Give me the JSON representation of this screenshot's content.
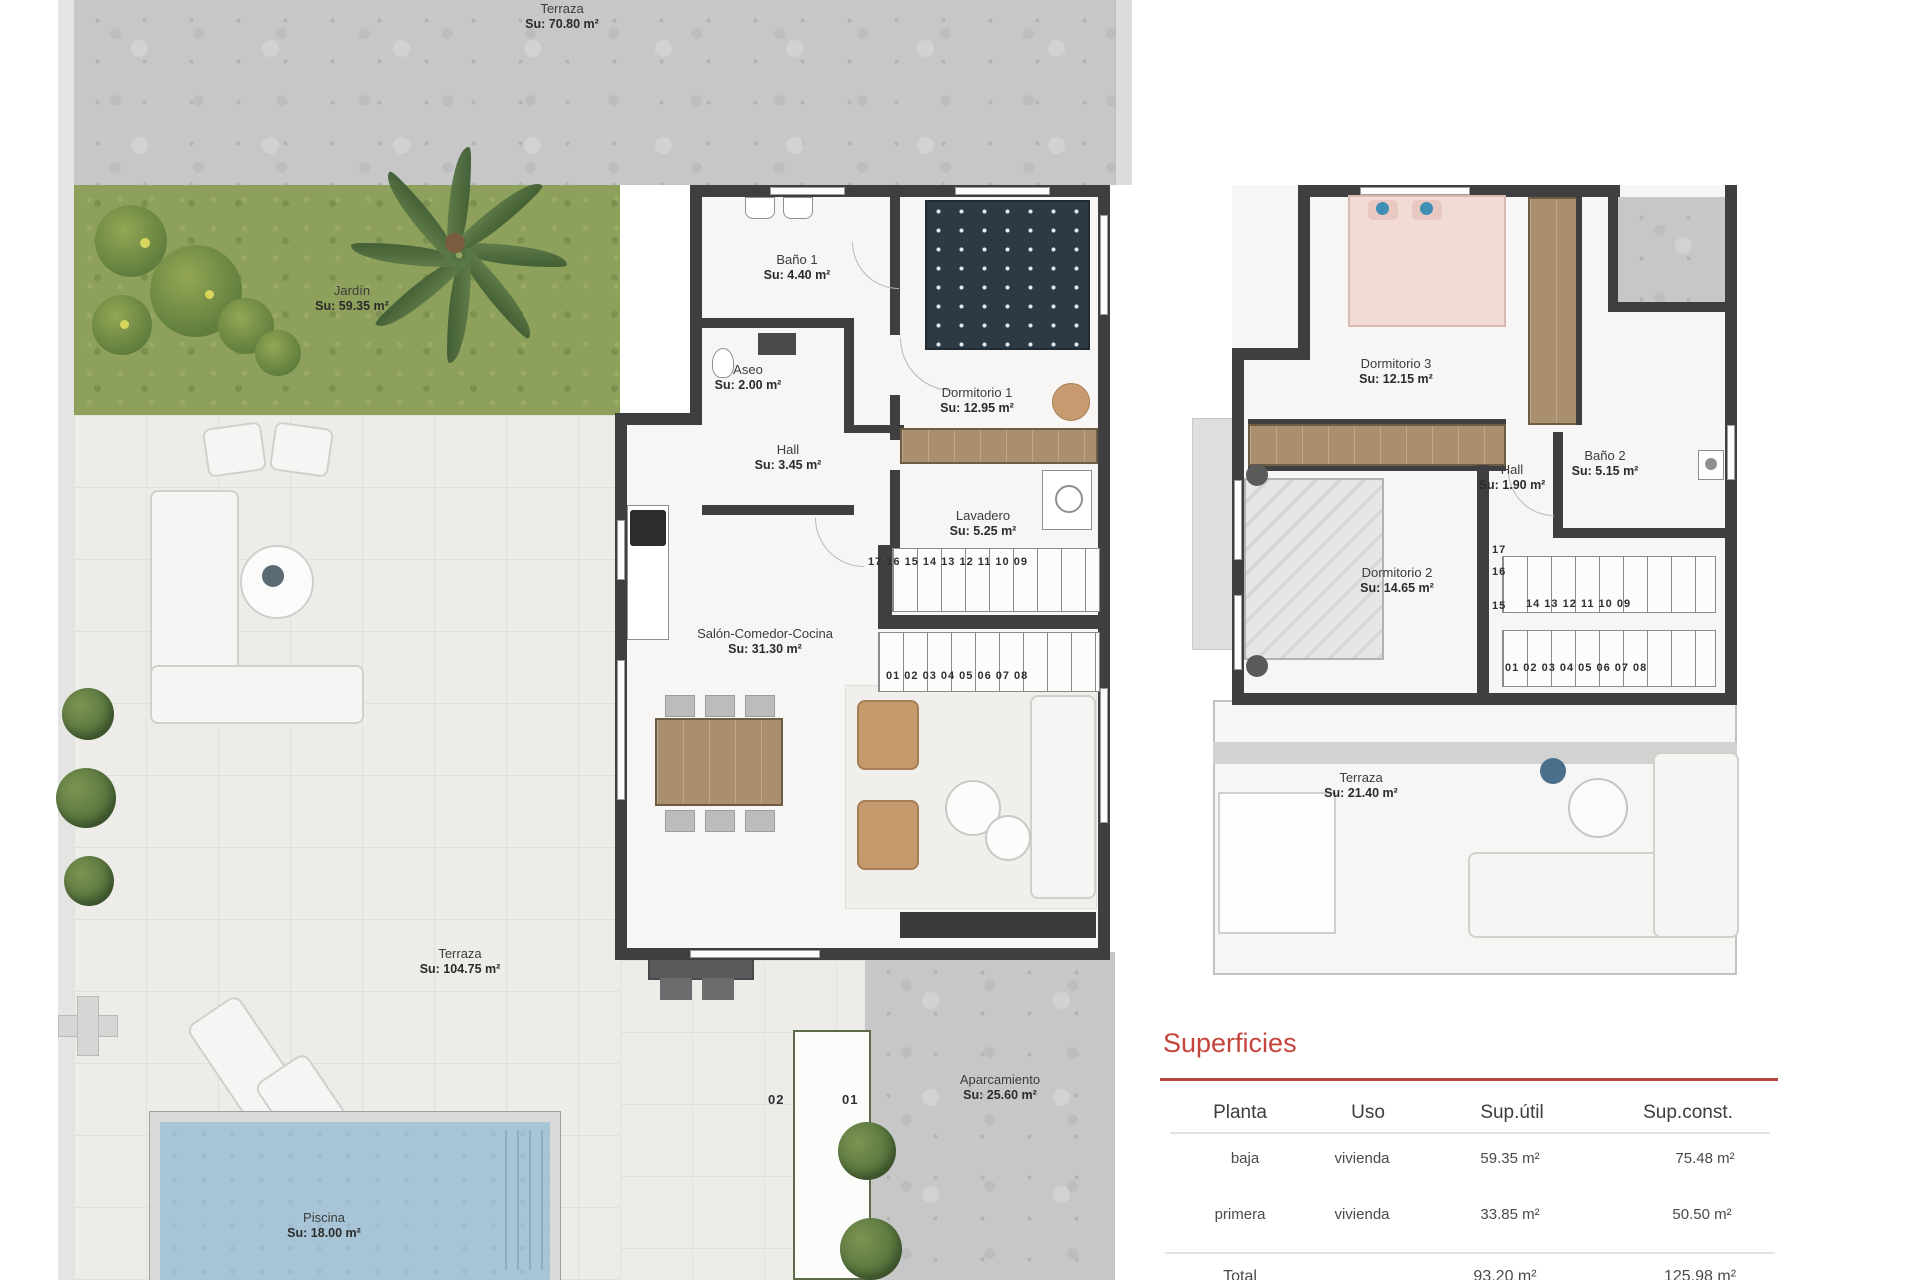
{
  "document": {
    "type": "floor-plan",
    "floors": [
      "planta baja",
      "planta primera"
    ]
  },
  "ground_floor": {
    "terraza_top": {
      "name": "Terraza",
      "area": "Su: 70.80 m²"
    },
    "jardin": {
      "name": "Jardín",
      "area": "Su: 59.35 m²"
    },
    "bano_1": {
      "name": "Baño 1",
      "area": "Su: 4.40 m²"
    },
    "aseo": {
      "name": "Aseo",
      "area": "Su: 2.00 m²"
    },
    "dormitorio_1": {
      "name": "Dormitorio 1",
      "area": "Su: 12.95 m²"
    },
    "hall": {
      "name": "Hall",
      "area": "Su: 3.45 m²"
    },
    "lavadero": {
      "name": "Lavadero",
      "area": "Su: 5.25 m²"
    },
    "salon_comedor_cocina": {
      "name": "Salón-Comedor-Cocina",
      "area": "Su: 31.30 m²"
    },
    "terraza": {
      "name": "Terraza",
      "area": "Su: 104.75 m²"
    },
    "piscina": {
      "name": "Piscina",
      "area": "Su: 18.00 m²"
    },
    "aparcamiento": {
      "name": "Aparcamiento",
      "area": "Su: 25.60 m²"
    },
    "parking_spot_left": "02",
    "parking_spot_right": "01",
    "stairs_row_upper": "17 16 15 14 13 12 11 10 09",
    "stairs_row_lower": "01 02 03 04 05 06 07 08"
  },
  "first_floor": {
    "dormitorio_3": {
      "name": "Dormitorio 3",
      "area": "Su: 12.15 m²"
    },
    "hall": {
      "name": "Hall",
      "area": "Su: 1.90 m²"
    },
    "bano_2": {
      "name": "Baño 2",
      "area": "Su: 5.15 m²"
    },
    "dormitorio_2": {
      "name": "Dormitorio 2",
      "area": "Su: 14.65 m²"
    },
    "terraza": {
      "name": "Terraza",
      "area": "Su: 21.40 m²"
    },
    "stairs_num_17": "17",
    "stairs_num_16": "16",
    "stairs_num_15": "15",
    "stairs_row_upper": "14 13 12 11 10 09",
    "stairs_row_lower": "01 02 03 04 05 06 07 08"
  },
  "superficies": {
    "title": "Superficies",
    "columns": [
      "Planta",
      "Uso",
      "Sup.útil",
      "Sup.const."
    ],
    "rows": [
      {
        "planta": "baja",
        "uso": "vivienda",
        "sup_util": "59.35 m²",
        "sup_const": "75.48 m²"
      },
      {
        "planta": "primera",
        "uso": "vivienda",
        "sup_util": "33.85 m²",
        "sup_const": "50.50 m²"
      },
      {
        "planta": "Total",
        "uso": "",
        "sup_util": "93.20 m²",
        "sup_const": "125.98 m²"
      }
    ]
  },
  "colors": {
    "accent_red": "#c4453c",
    "wall": "#3f3f41",
    "grass": "#8ea15c",
    "pool_water": "#a7c5d6",
    "wood": "#a98f6d",
    "concrete": "#c7c7c7"
  }
}
